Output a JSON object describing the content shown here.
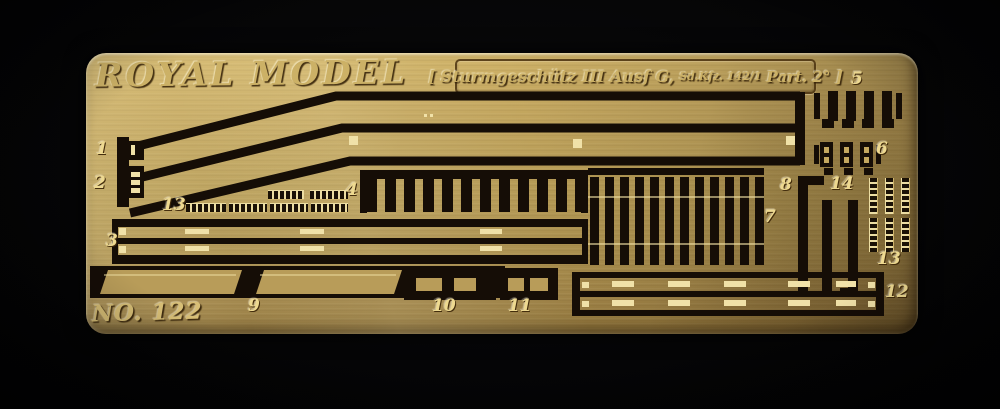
{
  "sheet": {
    "brand": "ROYAL MODEL",
    "number": "NO. 122",
    "plate": {
      "bracket_left": "[",
      "title": "Sturmgeschütz III Ausf G,",
      "code": "Sd.Kfz. 142/1",
      "part": "Part. 2°",
      "bracket_right": "]"
    },
    "colors": {
      "background": "#050507",
      "brass": "#b59a55",
      "etch_dark": "#150d06",
      "highlight": "#f0e1a8",
      "label_gold": "#eed990"
    },
    "part_labels": [
      {
        "label": "1"
      },
      {
        "label": "2"
      },
      {
        "label": "13"
      },
      {
        "label": "3"
      },
      {
        "label": "4"
      },
      {
        "label": "5"
      },
      {
        "label": "6"
      },
      {
        "label": "7"
      },
      {
        "label": "8"
      },
      {
        "label": "14"
      },
      {
        "label": "13"
      },
      {
        "label": "9"
      },
      {
        "label": "10"
      },
      {
        "label": "11"
      },
      {
        "label": "12"
      }
    ]
  }
}
